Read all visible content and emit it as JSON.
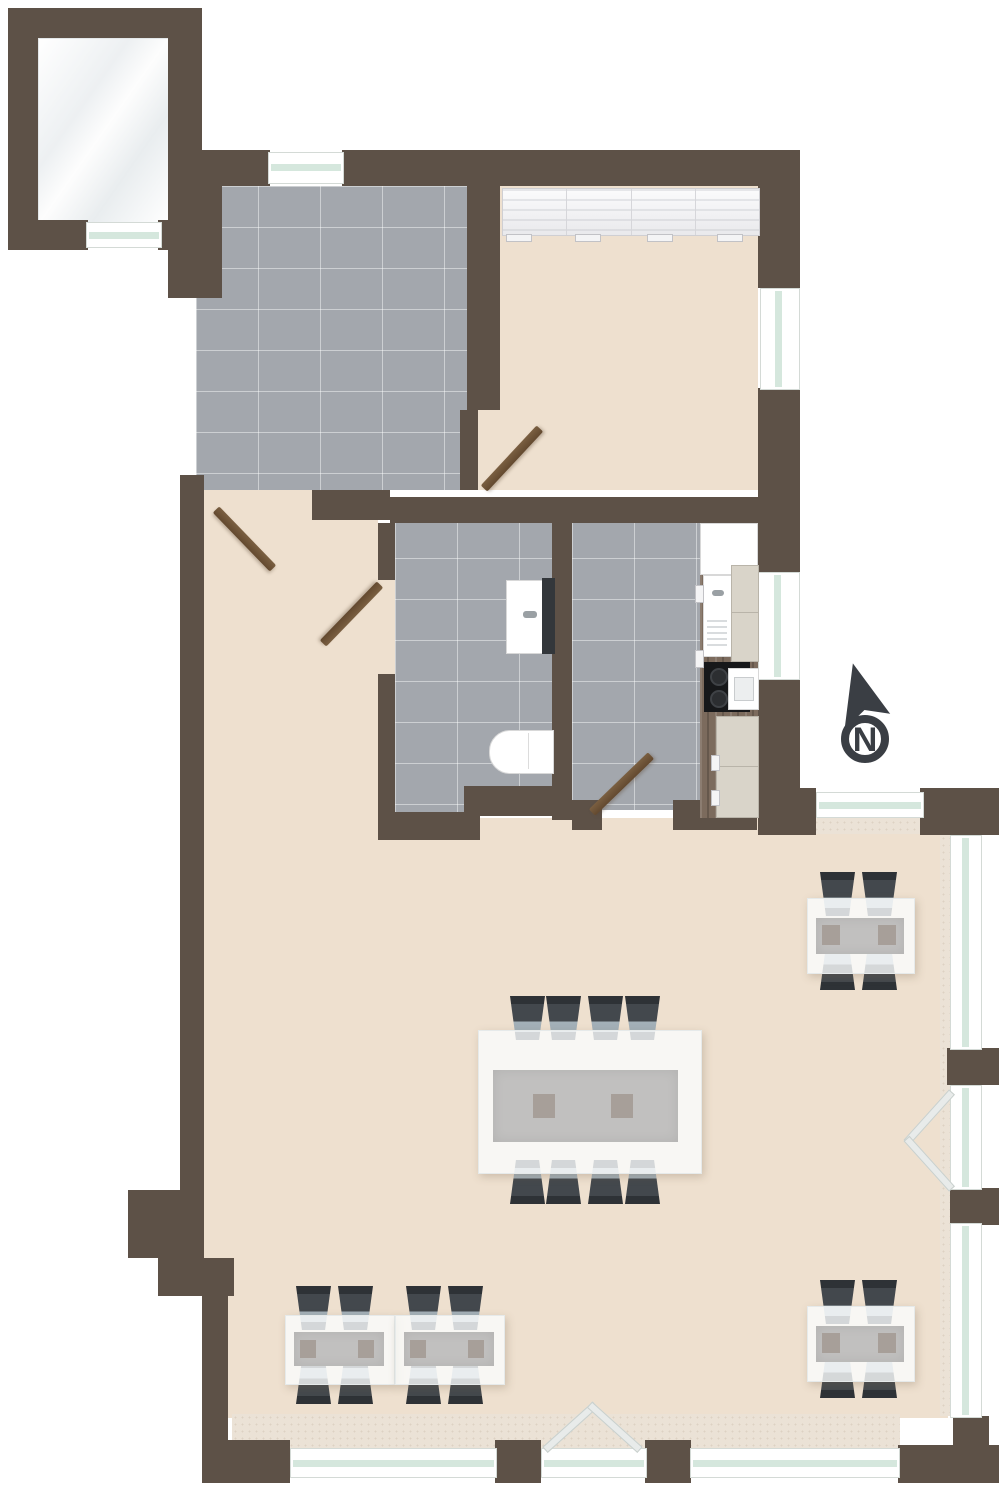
{
  "title": "Apartment floor plan",
  "north_arrow": {
    "label": "N"
  },
  "colors": {
    "wall": "#5d5147",
    "tile_floor": "#a3a7ad",
    "wood_floor": "#eee0cf",
    "balcony_floor": "#f4f6f7",
    "window_glass": "#d5e7dd",
    "interior_door": "#6d5438",
    "chair": "#43484d",
    "chair_seat": "#a3b0b8",
    "table_glass": "#f5f8f8",
    "counter": "#7c6b5d",
    "north_arrow": "#3a3e44"
  },
  "rooms": [
    {
      "name": "balcony-top-left",
      "floor": "white-gloss",
      "features": [
        "window-band-south"
      ]
    },
    {
      "name": "entry-hall",
      "floor": "gray-tile",
      "features": [
        "window-north",
        "door-to-corridor",
        "door-to-bedroom"
      ]
    },
    {
      "name": "bedroom",
      "floor": "wood-parquet",
      "features": [
        "wardrobe-4-panels",
        "window-east"
      ]
    },
    {
      "name": "corridor",
      "floor": "wood-parquet",
      "features": [
        "door-to-entry-hall",
        "door-to-bathroom"
      ]
    },
    {
      "name": "bathroom",
      "floor": "gray-tile",
      "fixtures": [
        "washbasin-with-dark-cabinet",
        "toilet"
      ]
    },
    {
      "name": "kitchen",
      "floor": "gray-tile",
      "fixtures": [
        "fridge",
        "sink-with-drainboard",
        "tall-cabinet",
        "cooktop-2-burners",
        "oven",
        "base-cabinets"
      ]
    },
    {
      "name": "living-dining-room",
      "floor": "wood-parquet",
      "features": [
        "window-northeast",
        "window-wall-east",
        "french-door-east",
        "windows-south",
        "french-door-south"
      ]
    }
  ],
  "furniture": {
    "wardrobe_sections": 4,
    "dining_tables": [
      {
        "name": "center-dining-table",
        "seats": 8,
        "placemats": 2
      },
      {
        "name": "left-table-1",
        "seats": 4,
        "placemats": 2
      },
      {
        "name": "left-table-2",
        "seats": 4,
        "placemats": 2
      },
      {
        "name": "right-top-table",
        "seats": 4,
        "placemats": 2
      },
      {
        "name": "right-bottom-table",
        "seats": 4,
        "placemats": 2
      }
    ],
    "total_chairs": 24
  },
  "doors": {
    "interior_swing_doors": 4,
    "french_doors": 2
  }
}
